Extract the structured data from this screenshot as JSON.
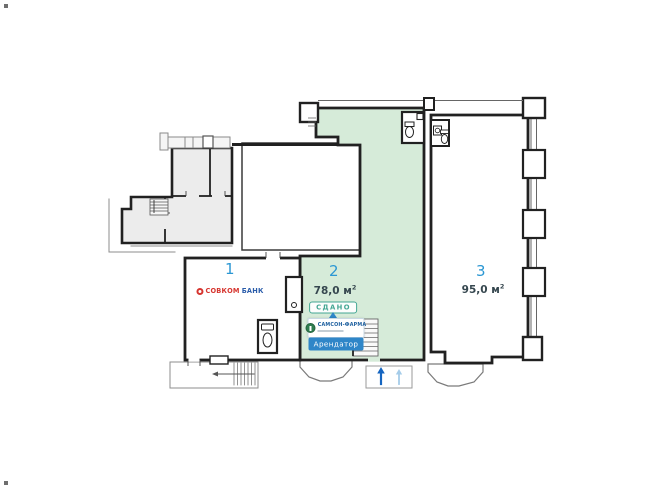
{
  "plan": {
    "type": "commercial-floor-plan",
    "colors": {
      "walls": "#212121",
      "unit_number_blue": "#2b97d3",
      "unit2_fill": "#d6ebd9",
      "gray_block_fill": "#ececec",
      "status_teal": "#43a693",
      "button_blue": "#2f86c8",
      "bank_red": "#d6352f",
      "bank_blue": "#2a5caa",
      "pharma_green": "#2e7d4f",
      "pharma_blue": "#1b5e9e"
    },
    "unit1": {
      "number": "1",
      "tenant_logo_part1": "СОВКОМ",
      "tenant_logo_part2": "БАНК"
    },
    "unit2": {
      "number": "2",
      "area": "78,0 м",
      "area_sup": "2",
      "status": "СДАНО",
      "tenant_name": "САМСОН-ФАРМА",
      "tenant_button": "Арендатор"
    },
    "unit3": {
      "number": "3",
      "area": "95,0 м",
      "area_sup": "2"
    }
  }
}
